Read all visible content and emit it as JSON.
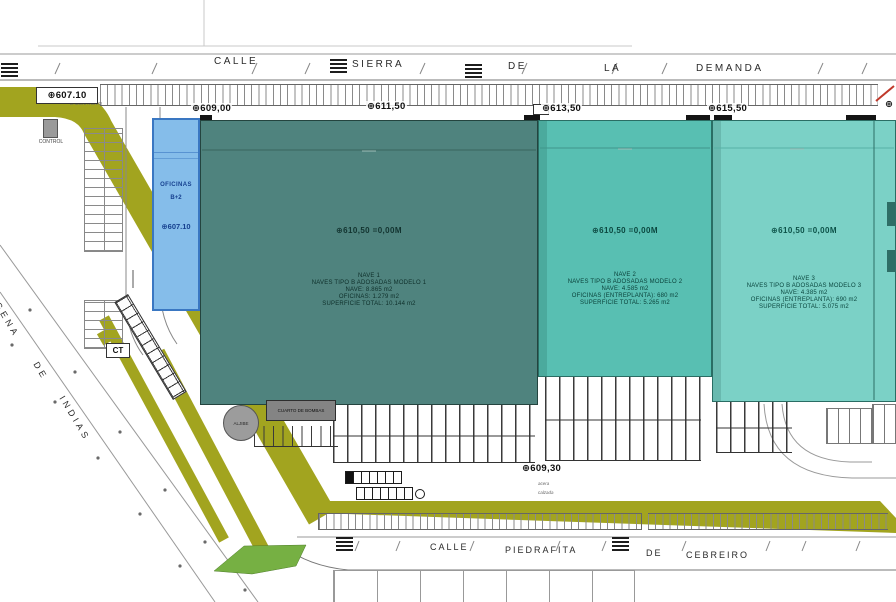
{
  "drawing": {
    "type": "industrial site plan"
  },
  "streets": {
    "top": {
      "full": "CALLE SIERRA DE LA DEMANDA",
      "words": [
        "CALLE",
        "SIERRA",
        "DE",
        "LA",
        "DEMANDA"
      ]
    },
    "bottom": {
      "full": "CALLE PIEDRAFITA DE CEBREIRO",
      "words": [
        "CALLE",
        "PIEDRAFITA",
        "DE",
        "CEBREIRO"
      ]
    },
    "diagonal": {
      "full": "CARTAGENA DE INDIAS",
      "words": [
        "CARTAGENA",
        "DE",
        "INDIAS"
      ]
    }
  },
  "levels": {
    "top_markers": [
      "⊕607.10",
      "⊕609,00",
      "⊕611,50",
      "⊕613,50",
      "⊕615,50"
    ],
    "edge_marker": "⊕",
    "bottom_marker": "⊕609,30",
    "bottom_notes": [
      "acera",
      "calzada"
    ]
  },
  "offices": {
    "title": "OFICINAS",
    "floors": "B+2",
    "level": "⊕607.10"
  },
  "naves": [
    {
      "level": "⊕610,50 =0,00M",
      "info": [
        "NAVE 1",
        "NAVES TIPO B ADOSADAS MODELO 1",
        "NAVE: 8.865 m2",
        "OFICINAS: 1.279 m2",
        "SUPERFICIE TOTAL: 10.144 m2"
      ]
    },
    {
      "level": "⊕610,50 =0,00M",
      "info": [
        "NAVE 2",
        "NAVES TIPO B ADOSADAS MODELO 2",
        "NAVE: 4.585 m2",
        "OFICINAS (ENTREPLANTA): 680 m2",
        "SUPERFICIE TOTAL: 5.265 m2"
      ]
    },
    {
      "level": "⊕610,50 =0,00M",
      "info": [
        "NAVE 3",
        "NAVES TIPO B ADOSADAS MODELO 3",
        "NAVE: 4.385 m2",
        "OFICINAS (ENTREPLANTA): 690 m2",
        "SUPERFICIE TOTAL: 5.075 m2"
      ]
    }
  ],
  "site_labels": {
    "control": "CONTROL",
    "gatehouse_note_1": "MUESTRAS",
    "gatehouse_note_2": "LABORATORIO",
    "ct": "CT",
    "aljibe": "ALJIBE",
    "pump_room": "CUARTO DE BOMBAS"
  },
  "colors": {
    "nave1": "#4f837e",
    "nave2": "#58bfb2",
    "nave3": "#7bd1c6",
    "offices_fill": "#85bdea",
    "offices_border": "#3a77c2",
    "olive_median": "#a2a41f",
    "green_patch": "#76b043"
  }
}
